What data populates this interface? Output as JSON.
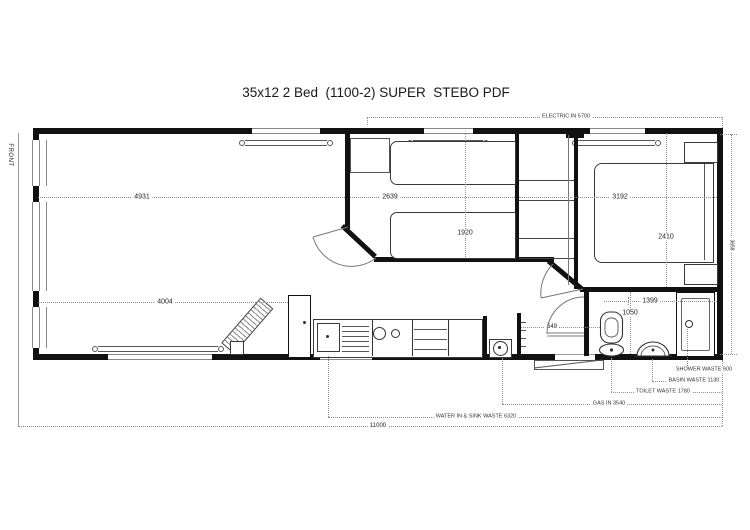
{
  "title": "35x12 2 Bed  (1100-2) SUPER  STEBO PDF",
  "front_label": "FRONT",
  "dimensions": {
    "lounge_length_top": "4931",
    "lounge_length_bottom": "4004",
    "twin_room_width": "2639",
    "twin_bed_length": "1920",
    "master_room_width": "3192",
    "master_bed_width": "2410",
    "bathroom_width": "1399",
    "bathroom_depth": "1050",
    "hall_width": "549",
    "overall_length": "11000",
    "overall_width": "3658"
  },
  "services": {
    "electric_in": "ELECTRIC IN 5700",
    "shower_waste": "SHOWER WASTE 600",
    "basin_waste": "BASIN WASTE 1130",
    "toilet_waste": "TOILET WASTE 1780",
    "gas_in": "GAS IN 3540",
    "water_in_sink_waste": "WATER IN & SINK WASTE 6320"
  }
}
